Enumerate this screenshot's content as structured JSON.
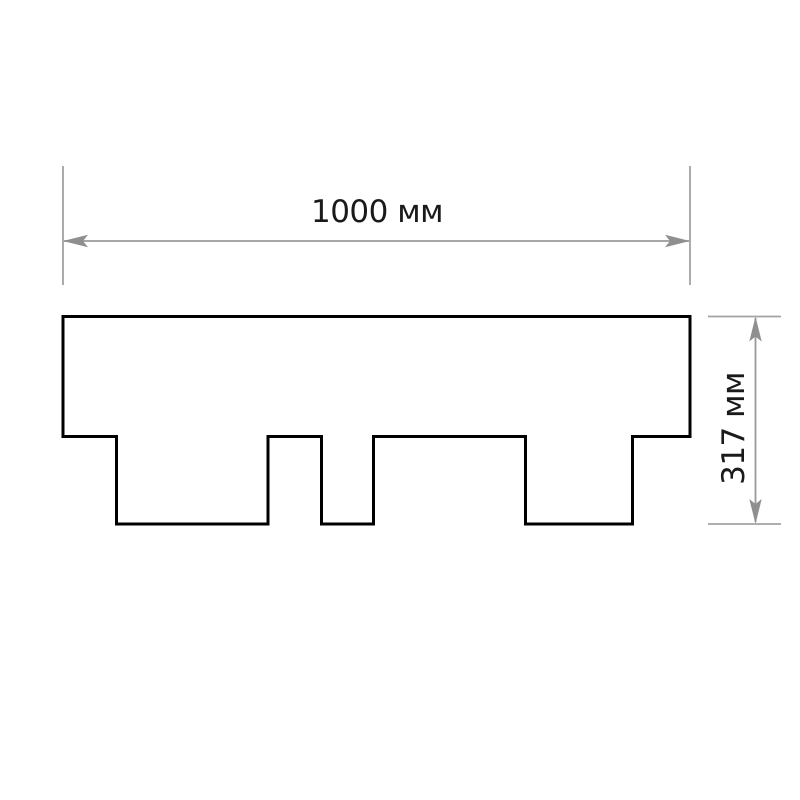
{
  "page": {
    "background_color": "#ffffff"
  },
  "diagram": {
    "type": "dimensioned-outline-drawing",
    "subject": "shingle-profile",
    "labels": {
      "width": "1000 мм",
      "height": "317 мм"
    },
    "dimensions_mm": {
      "width": 1000,
      "height": 317,
      "unit": "мм"
    },
    "colors": {
      "outline": "#000000",
      "dimension_line": "#999999",
      "extension_line": "#a3a3a3",
      "arrowhead": "#8f8f8f",
      "label_text": "#1a1a1a",
      "background": "#ffffff"
    },
    "geometry": {
      "outline": {
        "points": "63,316.5 690,316.5 690,436.5 632.5,436.5 632.5,524 525.5,524 525.5,436.5 373.5,436.5 373.5,524 321.5,524 321.5,436.5 268,436.5 268,524 116.5,524 116.5,436.5 63,436.5"
      },
      "width_ext_left": {
        "x1": 63,
        "y1": 166,
        "x2": 63,
        "y2": 285
      },
      "width_ext_right": {
        "x1": 690,
        "y1": 166,
        "x2": 690,
        "y2": 285
      },
      "width_line": {
        "x1": 64,
        "y1": 241,
        "x2": 689,
        "y2": 241
      },
      "width_arrow_left": {
        "points": "63,241 88,234.8 83,241 88,247.2"
      },
      "width_arrow_right": {
        "points": "690,241 665,234.8 670,241 665,247.2"
      },
      "width_label_pos": {
        "x": 377,
        "y": 222
      },
      "height_ext_top": {
        "x1": 708,
        "y1": 316.5,
        "x2": 781,
        "y2": 316.5
      },
      "height_ext_bottom": {
        "x1": 708,
        "y1": 524,
        "x2": 781,
        "y2": 524
      },
      "height_line": {
        "x1": 755.5,
        "y1": 318,
        "x2": 755.5,
        "y2": 522
      },
      "height_arrow_top": {
        "points": "755.5,316.5 749.3,341.5 755.5,336.5 761.7,341.5"
      },
      "height_arrow_bottom": {
        "points": "755.5,524 749.3,499 755.5,504 761.7,499"
      },
      "height_label_pos": {
        "x": 744,
        "y": 428.5,
        "transform": "rotate(-90 744 428.5)"
      }
    }
  }
}
